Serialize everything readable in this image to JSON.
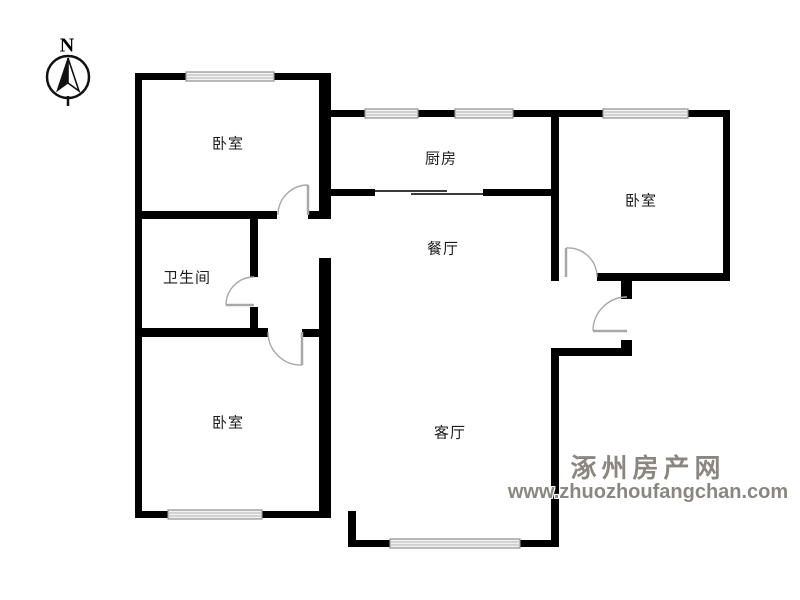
{
  "compass": {
    "label": "N"
  },
  "rooms": [
    {
      "id": "bedroom-top-left",
      "label": "卧室"
    },
    {
      "id": "kitchen",
      "label": "厨房"
    },
    {
      "id": "bedroom-right",
      "label": "卧室"
    },
    {
      "id": "dining-room",
      "label": "餐厅"
    },
    {
      "id": "bathroom",
      "label": "卫生间"
    },
    {
      "id": "bedroom-bottom-left",
      "label": "卧室"
    },
    {
      "id": "living-room",
      "label": "客厅"
    }
  ],
  "watermark": {
    "site_name": "涿州房产网",
    "site_url": "www.zhuozhoufangchan.com",
    "color": "#8b8680"
  },
  "colors": {
    "wall": "#000000",
    "door": "#a8a8a8",
    "window_frame": "#8f8f8f",
    "window_fill": "#f2f2f2",
    "background": "#ffffff"
  }
}
